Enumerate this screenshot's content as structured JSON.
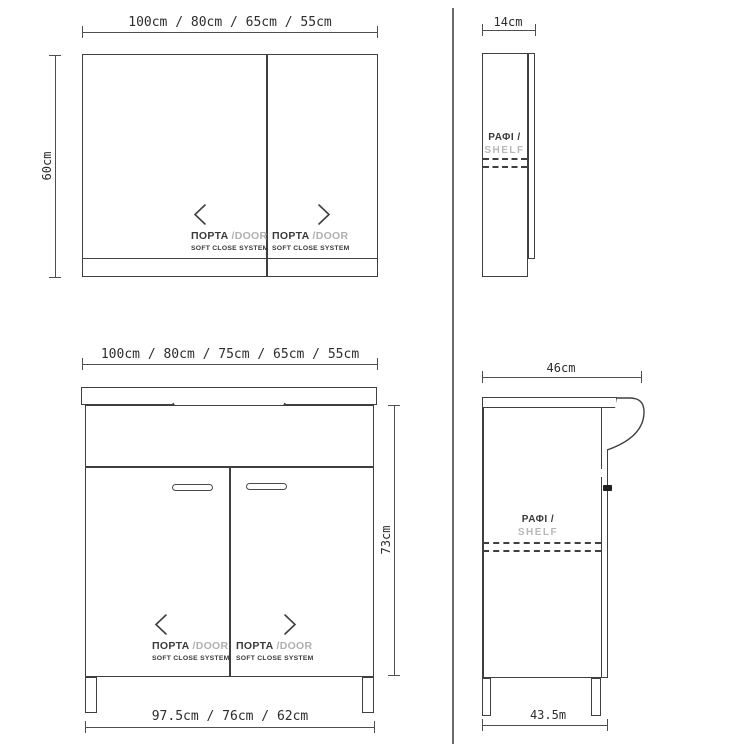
{
  "colors": {
    "line": "#3f3f3f",
    "dim_line": "#4f4f4f",
    "dim_text": "#2d2d2d",
    "label_dark": "#3a3a3a",
    "label_gray": "#b0b0b0",
    "view_divider": "#6a6a6a"
  },
  "mirror_front": {
    "width_dim": "100cm / 80cm / 65cm / 55cm",
    "height_dim": "60cm",
    "left_door": {
      "name": "ΠΟΡΤΑ",
      "alt": "/DOOR",
      "system": "SOFT CLOSE SYSTEM"
    },
    "right_door": {
      "name": "ΠΟΡΤΑ",
      "alt": "/DOOR",
      "system": "SOFT CLOSE SYSTEM"
    }
  },
  "mirror_side": {
    "depth_dim": "14cm",
    "shelf": "ΡΑΦΙ /",
    "shelf_alt": "SHELF"
  },
  "vanity_front": {
    "width_dim": "100cm / 80cm / 75cm / 65cm / 55cm",
    "height_dim": "73cm",
    "plinth_dim": "97.5cm / 76cm / 62cm",
    "left_door": {
      "name": "ΠΟΡΤΑ",
      "alt": "/DOOR",
      "system": "SOFT CLOSE SYSTEM"
    },
    "right_door": {
      "name": "ΠΟΡΤΑ",
      "alt": "/DOOR",
      "system": "SOFT CLOSE SYSTEM"
    }
  },
  "vanity_side": {
    "depth_dim": "46cm",
    "plinth_dim": "43.5m",
    "shelf": "ΡΑΦΙ /",
    "shelf_alt": "SHELF"
  }
}
